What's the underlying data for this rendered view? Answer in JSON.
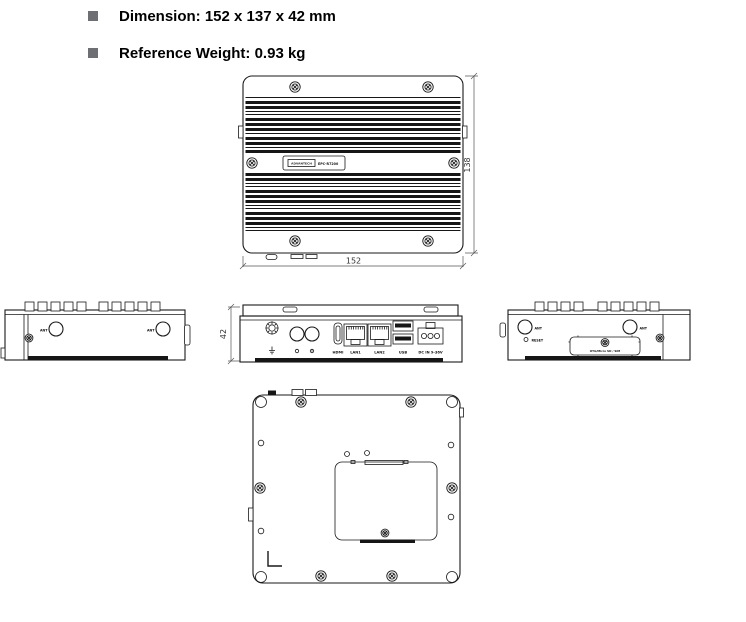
{
  "bullets": [
    {
      "icon": "square-bullet-icon",
      "label": "Dimension: 152 x 137 x 42 mm"
    },
    {
      "icon": "square-bullet-icon",
      "label": "Reference Weight: 0.93 kg"
    }
  ],
  "colors": {
    "bullet_square": "#6e6f72",
    "drawing_line": "#1a1a1a",
    "dimension_line": "#555555",
    "foot_bar": "#161616",
    "background": "#ffffff"
  },
  "top_view": {
    "brand_logo": "ADVANTECH",
    "model": "EPC-R7200",
    "width_dim": "152",
    "height_dim": "138"
  },
  "left_side_view": {
    "ant_label": "ANT"
  },
  "front_view": {
    "height_dim": "42",
    "port_labels": {
      "hdmi": "HDMI",
      "lan1": "LAN1",
      "lan2": "LAN2",
      "usb": "USB",
      "dc_in": "DC IN 9-36V"
    }
  },
  "right_side_view": {
    "ant_label": "ANT",
    "reset_label": "RESET",
    "panel_label": "OTG/Micro SD / SIM"
  },
  "icons": [
    "square-bullet-icon",
    "phillips-screw-icon",
    "corner-hole-icon",
    "ant-hole-icon",
    "grounding-screw-icon",
    "earth-ground-icon",
    "indicator-dot-icon"
  ]
}
